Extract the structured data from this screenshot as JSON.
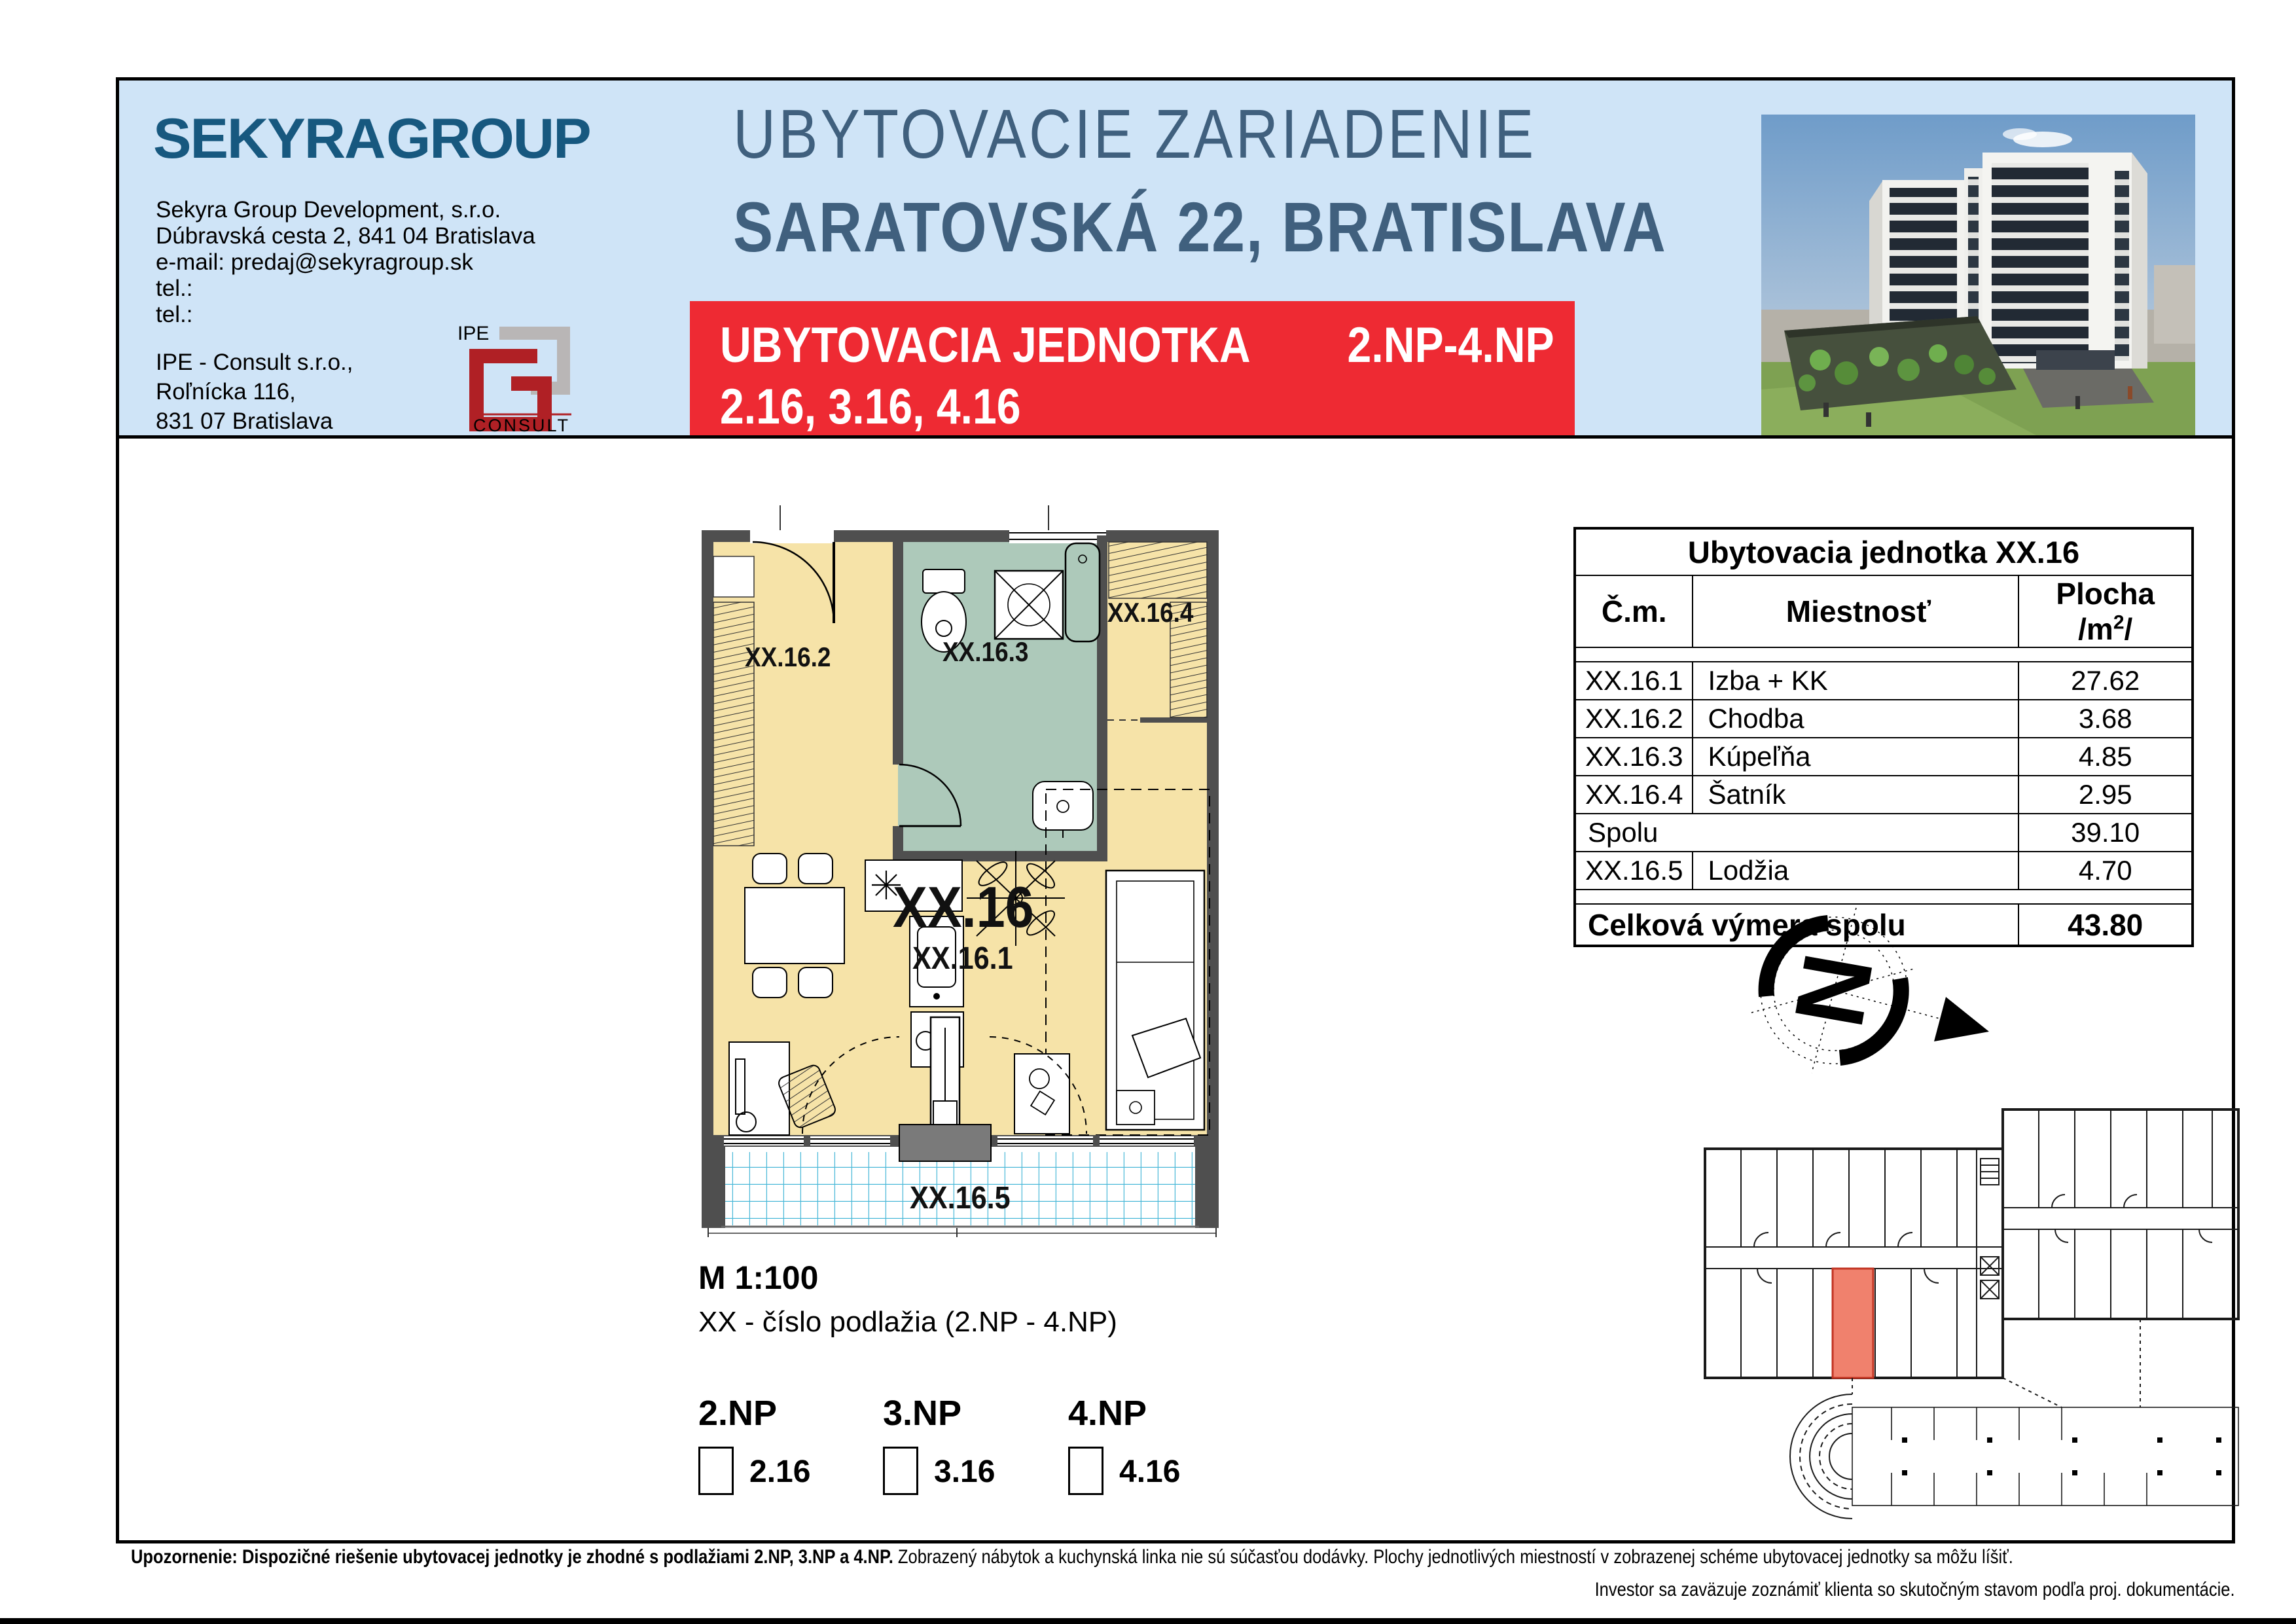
{
  "header": {
    "logo": "SEKYRA GROUP",
    "company_lines": [
      "Sekyra Group Development, s.r.o.",
      "Dúbravská cesta 2, 841 04 Bratislava",
      "e-mail: predaj@sekyragroup.sk",
      "tel.:",
      "tel.:"
    ],
    "ipe_lines": [
      "IPE - Consult s.r.o.,",
      "Roľnícka 116,",
      "831 07 Bratislava"
    ],
    "ipe_logo": {
      "top": "IPE",
      "bottom": "CONSULT"
    },
    "title_line1": "UBYTOVACIE ZARIADENIE",
    "title_line2": "SARATOVSKÁ 22, BRATISLAVA",
    "banner": {
      "label": "UBYTOVACIA JEDNOTKA",
      "floors": "2.NP-4.NP",
      "units": "2.16, 3.16, 4.16"
    }
  },
  "plan": {
    "labels": {
      "chodba": "XX.16.2",
      "kupelna": "XX.16.3",
      "satnik": "XX.16.4",
      "unit": "XX.16",
      "izba": "XX.16.1",
      "lodzia": "XX.16.5"
    },
    "scale": "M 1:100",
    "note": "XX - číslo podlažia (2.NP - 4.NP)"
  },
  "floor_selector": [
    {
      "floor": "2.NP",
      "unit": "2.16"
    },
    {
      "floor": "3.NP",
      "unit": "3.16"
    },
    {
      "floor": "4.NP",
      "unit": "4.16"
    }
  ],
  "table": {
    "title": "Ubytovacia jednotka XX.16",
    "headers": {
      "cm": "Č.m.",
      "room": "Miestnosť",
      "area_base": "Plocha /m",
      "area_sup": "2",
      "area_end": "/"
    },
    "rows": [
      {
        "cm": "XX.16.1",
        "room": "Izba + KK",
        "area": "27.62"
      },
      {
        "cm": "XX.16.2",
        "room": "Chodba",
        "area": "3.68"
      },
      {
        "cm": "XX.16.3",
        "room": "Kúpeľňa",
        "area": "4.85"
      },
      {
        "cm": "XX.16.4",
        "room": "Šatník",
        "area": "2.95"
      }
    ],
    "subtotal": {
      "label": "Spolu",
      "area": "39.10"
    },
    "loggia_row": {
      "cm": "XX.16.5",
      "room": "Lodžia",
      "area": "4.70"
    },
    "total": {
      "label": "Celková výmera spolu",
      "area": "43.80"
    }
  },
  "compass": {
    "letter": "N"
  },
  "footer": {
    "bold": "Upozornenie: Dispozičné riešenie ubytovacej jednotky je zhodné s podlažiami 2.NP, 3.NP a 4.NP.",
    "regular": " Zobrazený nábytok a kuchynská linka nie sú súčasťou dodávky. Plochy jednotlivých miestností v zobrazenej schéme ubytovacej jednotky sa môžu líšiť.",
    "line2": "Investor sa zaväzuje zoznámiť klienta so skutočným stavom podľa proj. dokumentácie."
  },
  "colors": {
    "header_blue": "#cfe4f7",
    "accent_red": "#ee2a33",
    "title_blue": "#40607e",
    "logo_navy": "#17587f",
    "room_cream": "#f6e3a8",
    "bath_green": "#adc9ba",
    "loggia_cyan": "#49b8d8",
    "wall_gray": "#4f4f4f",
    "highlight_salmon": "#f0816d"
  }
}
